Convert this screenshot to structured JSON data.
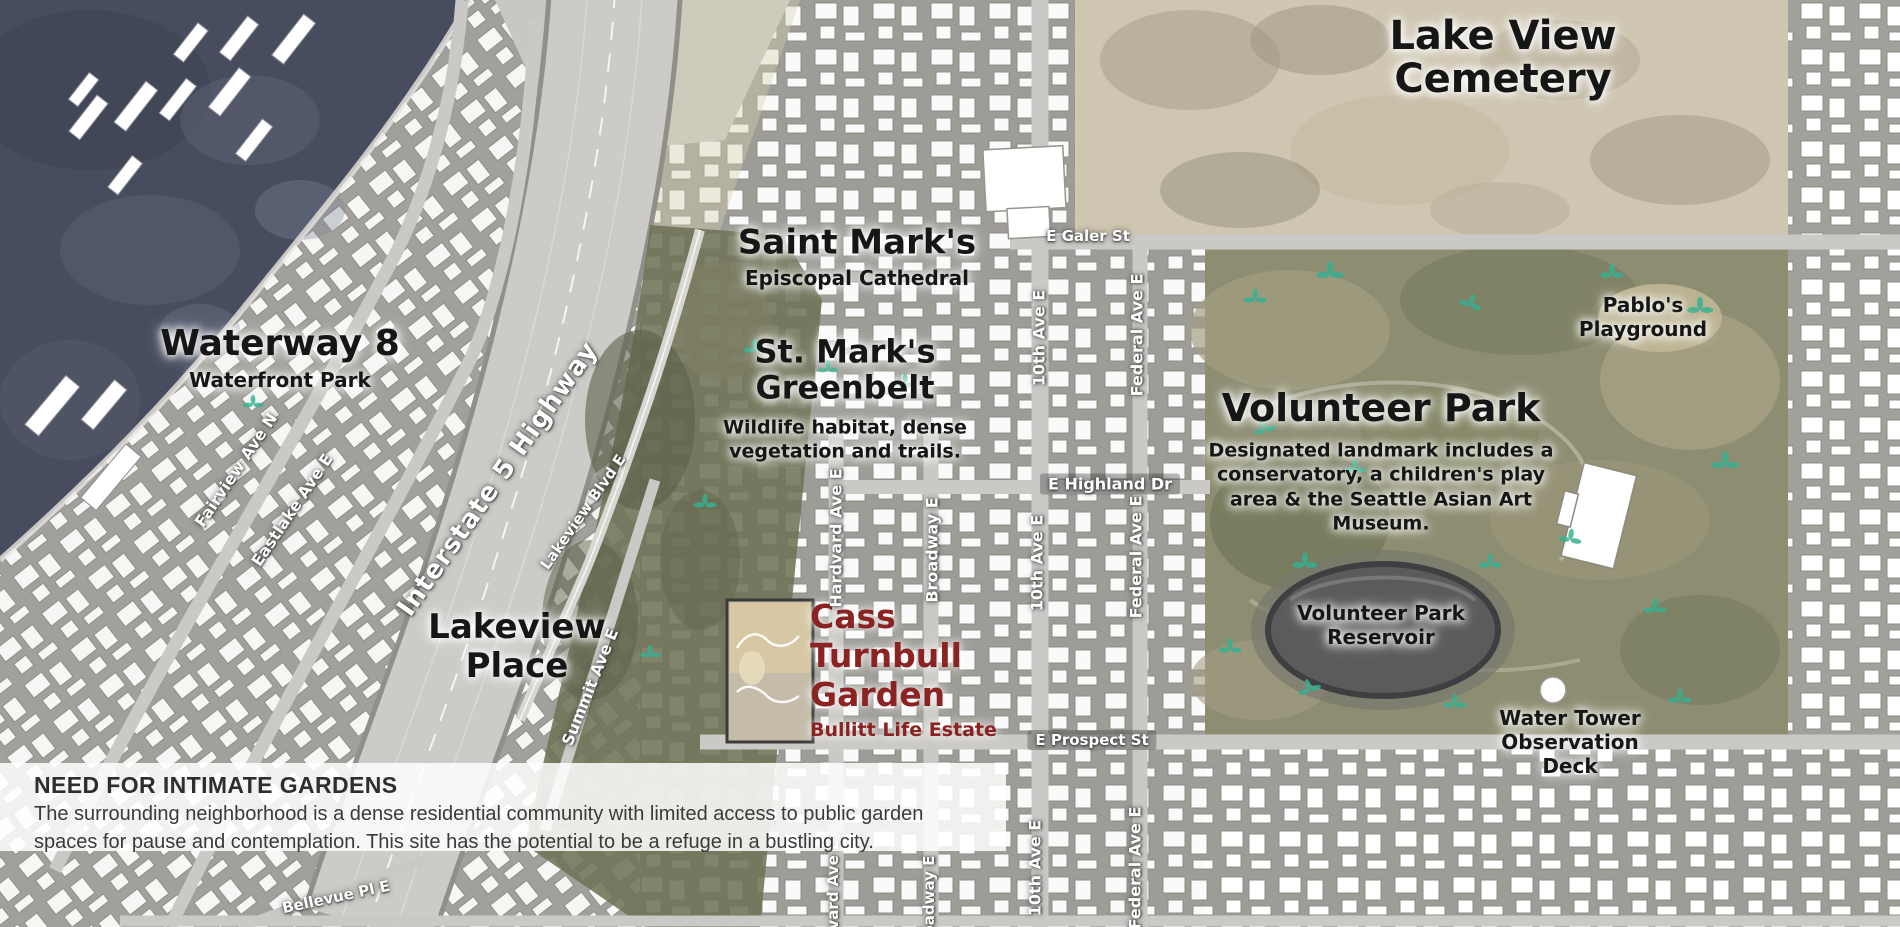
{
  "map": {
    "areas": {
      "cemetery": {
        "lines": [
          "Lake View",
          "Cemetery"
        ]
      },
      "waterway": {
        "title": "Waterway 8",
        "subtitle": "Waterfront Park"
      },
      "saint_marks": {
        "title": "Saint Mark's",
        "subtitle": "Episcopal Cathedral"
      },
      "greenbelt": {
        "lines": [
          "St. Mark's",
          "Greenbelt"
        ],
        "desc_lines": [
          "Wildlife habitat, dense",
          "vegetation and trails."
        ]
      },
      "volunteer_park": {
        "title": "Volunteer Park",
        "desc": "Designated landmark includes a conservatory, a children's play area & the Seattle Asian Art Museum."
      },
      "pablos": {
        "lines": [
          "Pablo's",
          "Playground"
        ]
      },
      "reservoir": {
        "lines": [
          "Volunteer Park",
          "Reservoir"
        ]
      },
      "water_tower": {
        "lines": [
          "Water Tower",
          "Observation",
          "Deck"
        ]
      },
      "lakeview_place": {
        "lines": [
          "Lakeview",
          "Place"
        ]
      },
      "site": {
        "lines": [
          "Cass",
          "Turnbull",
          "Garden"
        ],
        "subtitle": "Bullitt Life Estate"
      }
    },
    "streets": {
      "fairview": "Fairview Ave N",
      "eastlake": "Eastlake Ave E",
      "i5": "Interstate 5 Highway",
      "lakeview_blvd": "Lakeview Blvd E",
      "summit": "Summit Ave E",
      "harvard": "Hardvard Ave E",
      "broadway": "Broadway E",
      "tenth": "10th Ave E",
      "federal": "Federal Ave E",
      "galer": "E Galer St",
      "highland": "E Highland Dr",
      "prospect": "E Prospect St",
      "bellevue": "Bellevue Pl E"
    },
    "note": {
      "heading": "NEED FOR INTIMATE GARDENS",
      "body": "The surrounding neighborhood is a dense residential community with limited access to public garden spaces for pause and contemplation. This site has the potential to be a refuge in a bustling city."
    },
    "colors": {
      "site_accent": "#8a2322",
      "water": "#474d5e",
      "park": "#8d8d72",
      "cemetery": "#cfc6b1",
      "sprout": "#36b091",
      "note_background": "rgba(255,255,255,0.85)"
    }
  }
}
